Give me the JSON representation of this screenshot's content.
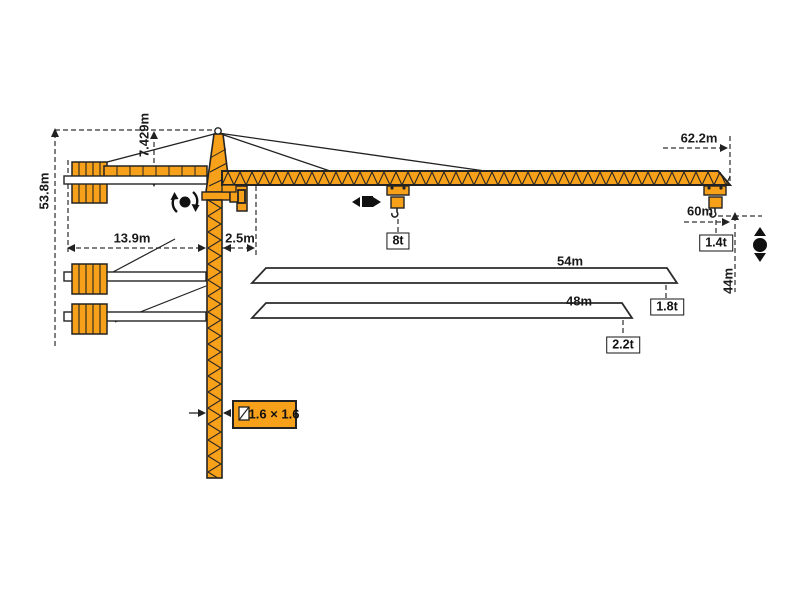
{
  "diagram": {
    "type": "tower-crane-specification-drawing",
    "colors": {
      "crane_orange": "#F7A11A",
      "outline": "#232323",
      "dimension_line": "#333333",
      "background": "#FFFFFF"
    },
    "dimensions": {
      "total_height": "53.8m",
      "tower_head_height": "7.429m",
      "counter_jib_length": "13.9m",
      "jib_root_offset": "2.5m",
      "max_working_radius": "62.2m",
      "radius_60": "60m",
      "hook_clearance": "44m",
      "jib_option_54": "54m",
      "jib_option_48": "48m"
    },
    "capacities": {
      "max_load": "8t",
      "tip_load_62m": "1.4t",
      "tip_load_54m": "1.8t",
      "tip_load_48m": "2.2t"
    },
    "mast": {
      "section_size": "1.6 × 1.6"
    },
    "icons": [
      "slewing-icon",
      "trolley-travel-icon",
      "hoist-icon",
      "mast-cross-section-icon"
    ]
  }
}
